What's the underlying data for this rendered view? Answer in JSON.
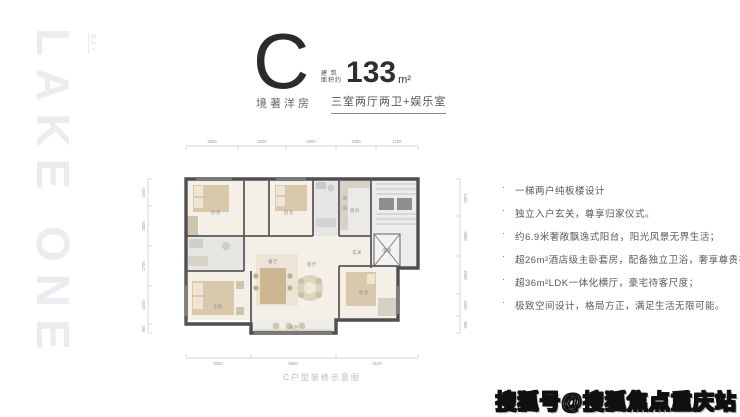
{
  "brand_watermark": {
    "text": "LAKE ONE",
    "sub_text": "BAY"
  },
  "header": {
    "unit_letter": "C",
    "area_label_line1": "建 筑",
    "area_label_line2": "面积约",
    "area_value": "133",
    "area_unit": "m²",
    "series_name": "境著洋房",
    "layout_text": "三室两厅两卫+娱乐室"
  },
  "features": {
    "bullet": "·",
    "items": [
      "一梯两户纯板楼设计",
      "独立入户玄关，尊享归家仪式。",
      "约6.9米奢敞飘逸式阳台，阳光风景无界生活；",
      "超26m²酒店级主卧套房，配备独立卫浴，奢享尊贵礼遇",
      "超36m²LDK一体化横厅，豪宅待客尺度；",
      "极致空间设计，格局方正，满足生活无限可能。"
    ]
  },
  "floorplan": {
    "caption": "C户型装修示意图",
    "room_labels": [
      "卧室",
      "卧室",
      "厨房",
      "客厅",
      "餐厅",
      "主卧",
      "阳台",
      "卧室",
      "玄关",
      "电梯"
    ],
    "dims_top": [
      "3500",
      "3200",
      "3300",
      "1500",
      "1100"
    ],
    "dims_left": [
      "1500",
      "3300",
      "2700",
      "4200",
      "900"
    ],
    "dims_right": [
      "1400",
      "3600",
      "2500",
      "1000",
      "800"
    ],
    "dims_bottom": [
      "3300",
      "9800",
      "2100"
    ]
  },
  "footer_watermark": {
    "text": "搜狐号@搜狐焦点重庆站"
  },
  "colors": {
    "wall": "#4f4f4f",
    "beige": "#d9c8ac",
    "brand_gray": "#eaecef"
  }
}
